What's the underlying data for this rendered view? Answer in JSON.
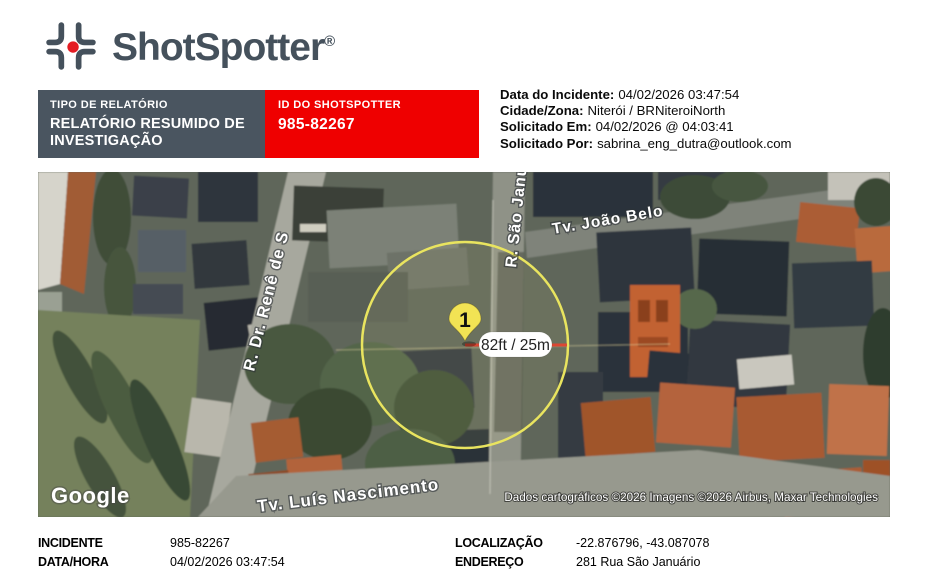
{
  "logo": {
    "brand": "ShotSpotter",
    "registered": "®"
  },
  "header": {
    "report_type_label": "TIPO DE RELATÓRIO",
    "report_type_value": "RELATÓRIO RESUMIDO DE INVESTIGAÇÃO",
    "id_label": "ID DO SHOTSPOTTER",
    "id_value": "985-82267",
    "details": [
      {
        "label": "Data do Incidente:",
        "value": "04/02/2026 03:47:54"
      },
      {
        "label": "Cidade/Zona:",
        "value": "Niterói / BRNiteroiNorth"
      },
      {
        "label": "Solicitado Em:",
        "value": "04/02/2026 @ 04:03:41"
      },
      {
        "label": "Solicitado Por:",
        "value": "sabrina_eng_dutra@outlook.com"
      }
    ]
  },
  "map": {
    "marker_number": "1",
    "radius_label": "82ft / 25m",
    "streets": {
      "rene": "R. Dr. Renê de S",
      "sao_januario": "R. São Janu",
      "joao_belo": "Tv. João Belo",
      "luis_nascimento": "Tv. Luís Nascimento"
    },
    "google_logo": "Google",
    "attribution": "Dados cartográficos ©2026 Imagens ©2026 Airbus, Maxar Technologies"
  },
  "footer": {
    "rows_left": [
      {
        "label": "INCIDENTE",
        "value": "985-82267"
      },
      {
        "label": "DATA/HORA",
        "value": "04/02/2026 03:47:54"
      }
    ],
    "rows_right": [
      {
        "label": "LOCALIZAÇÃO",
        "value": "-22.876796, -43.087078"
      },
      {
        "label": "ENDEREÇO",
        "value": "281 Rua São Januário"
      }
    ]
  },
  "colors": {
    "brand_text": "#45515c",
    "logo_dot": "#e41c23",
    "bar_dark": "#4a5560",
    "bar_red": "#ef0000",
    "circle_stroke": "#e9e45f",
    "measure_line": "#dc4733",
    "pin_fill": "#f2e354"
  }
}
